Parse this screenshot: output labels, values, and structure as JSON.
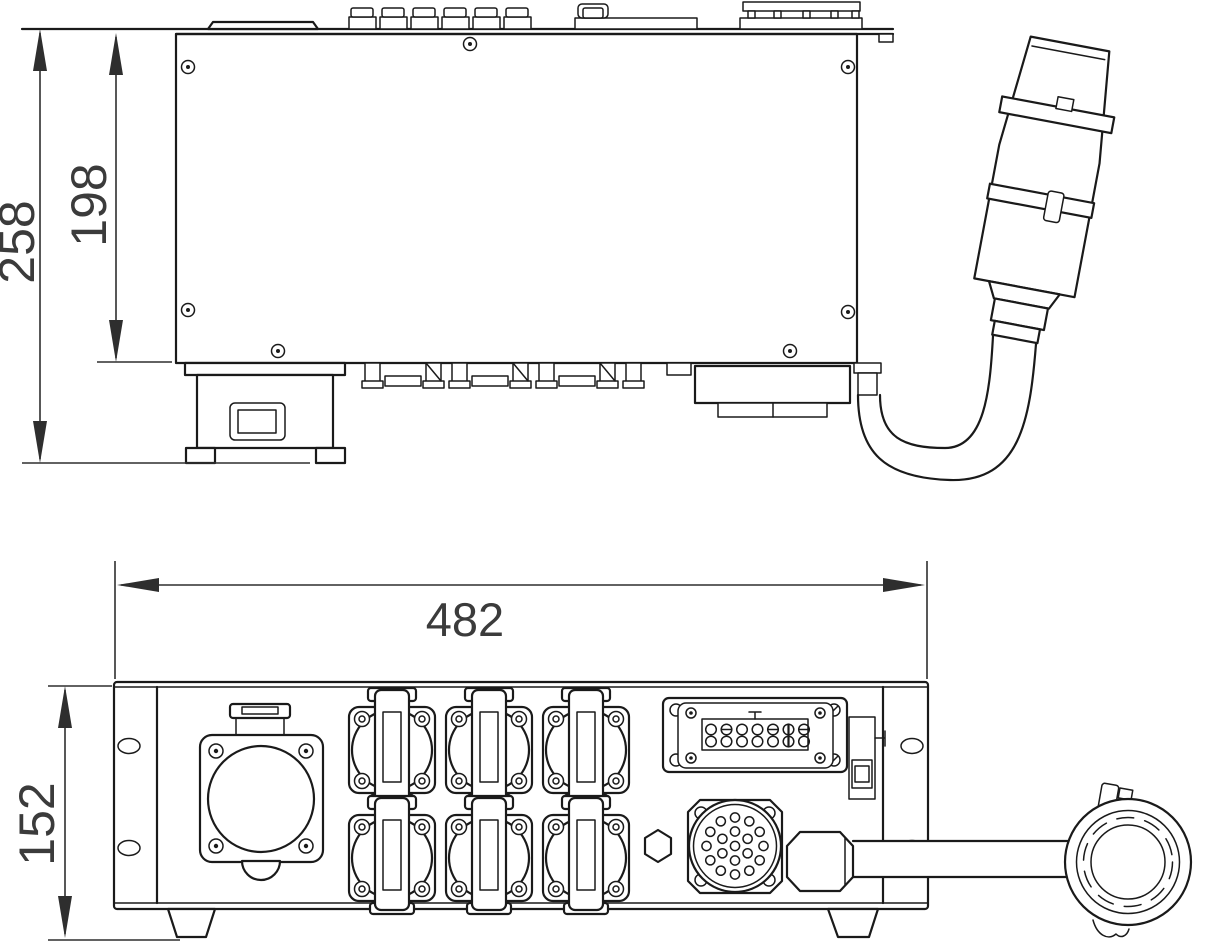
{
  "drawing": {
    "kind": "two-view technical dimension drawing of rack power distributor",
    "views": [
      {
        "id": "top-view",
        "dimension_labels": [
          "258",
          "198"
        ]
      },
      {
        "id": "front-view",
        "dimension_labels": [
          "482",
          "152"
        ]
      }
    ]
  },
  "dimensions": {
    "overall_depth": "258",
    "body_depth": "198",
    "overall_width": "482",
    "panel_height": "152"
  },
  "colors": {
    "line": "#1a1a1a",
    "dimension_text": "#3b3b3b",
    "background": "#ffffff"
  }
}
